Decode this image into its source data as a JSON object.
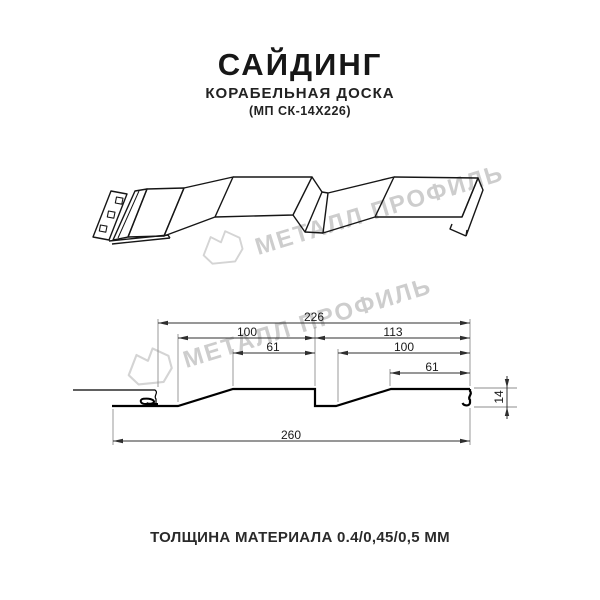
{
  "header": {
    "title": "САЙДИНГ",
    "subtitle": "КОРАБЕЛЬНАЯ ДОСКА",
    "model_code": "(МП СК-14Х226)"
  },
  "watermark": {
    "brand_text": "МЕТАЛЛ ПРОФИЛЬ",
    "logo_icon": "metall-profil-logo",
    "color": "#cdcdcd"
  },
  "drawing": {
    "views": [
      "3d-perspective-profile",
      "cross-section-with-dimensions"
    ],
    "dimensions_mm": {
      "overall_top": "226",
      "left_panel_top": "100",
      "right_panel_top": "113",
      "left_panel_flat": "61",
      "right_panel_mid": "100",
      "right_panel_flat": "61",
      "overall_bottom": "260",
      "profile_height": "14"
    }
  },
  "footer": {
    "thickness_note": "ТОЛЩИНА МАТЕРИАЛА 0.4/0,45/0,5 ММ"
  }
}
